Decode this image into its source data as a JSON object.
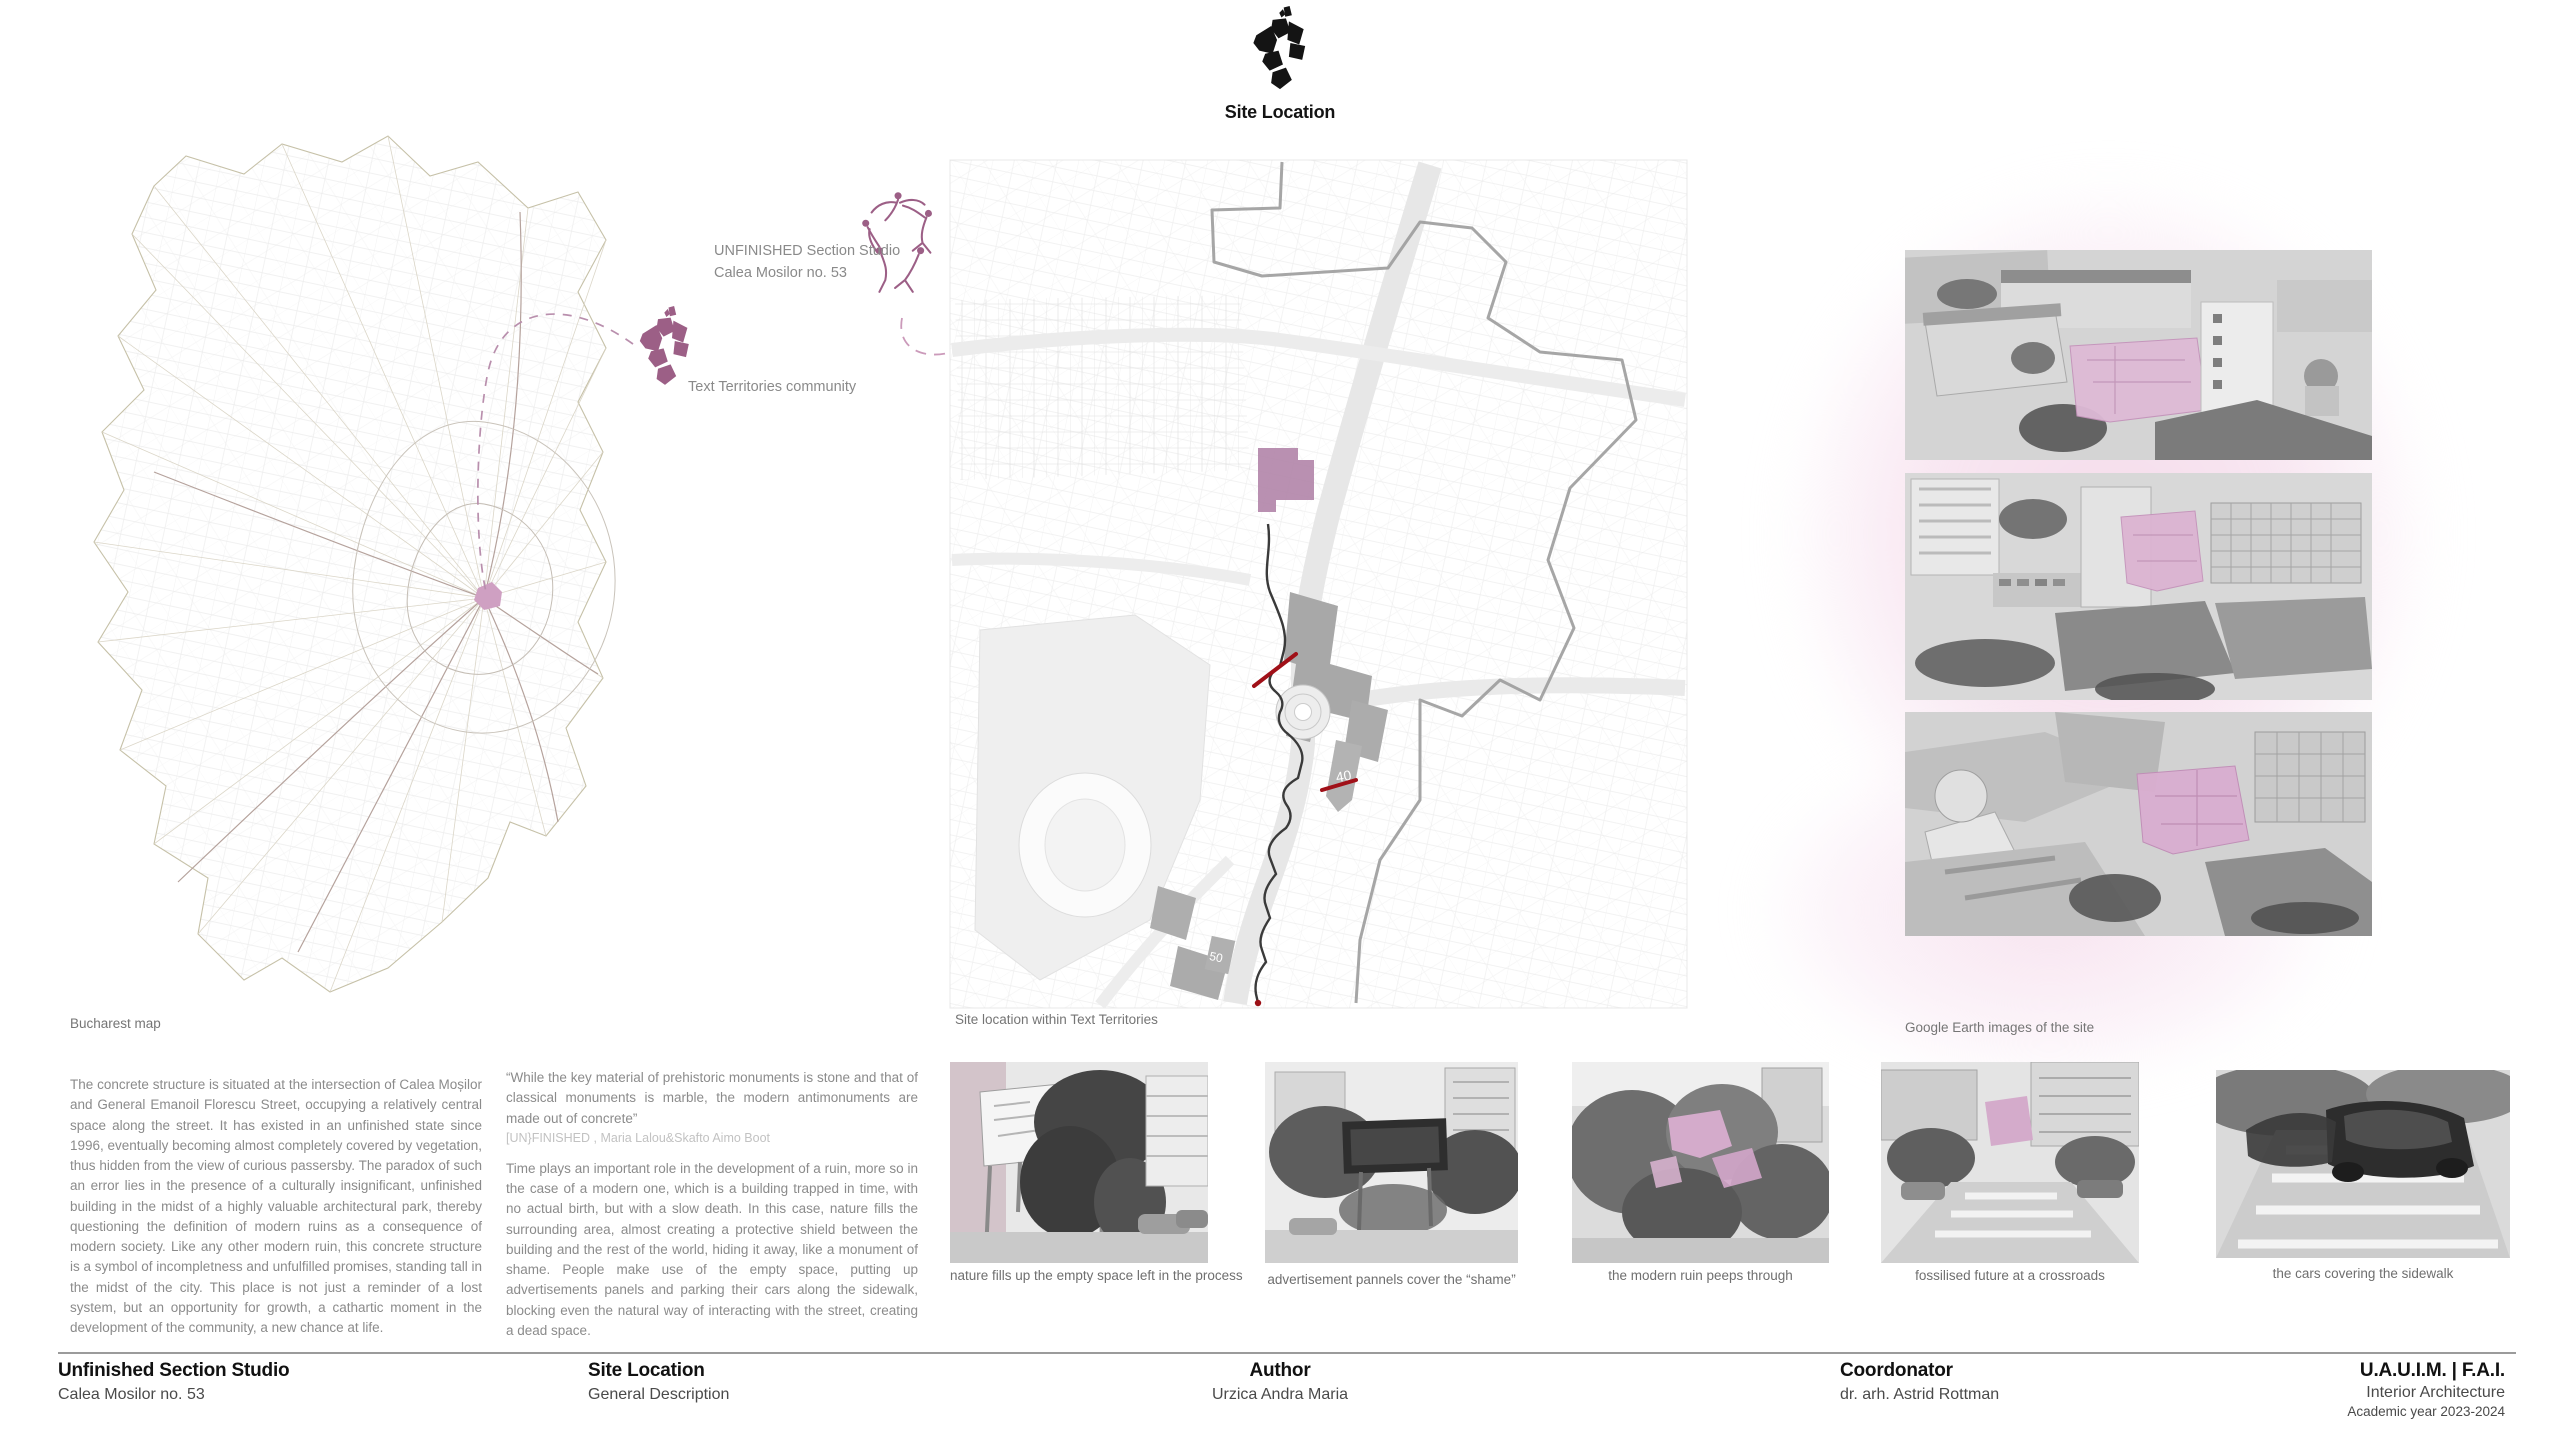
{
  "header": {
    "title": "Site Location",
    "logo_icon": "fragmented-city-plan-logo"
  },
  "annotations": {
    "studio_line1": "UNFINISHED Section Studio",
    "studio_line2": "Calea Mosilor no. 53",
    "community_label": "Text Territories community"
  },
  "captions": {
    "bucharest_map": "Bucharest map",
    "site_map": "Site location within Text Territories",
    "google_earth": "Google Earth images of the site"
  },
  "site_map": {
    "labels": [
      "40",
      "50"
    ]
  },
  "body": {
    "paragraph1": "The concrete structure is situated at the intersection of Calea Moșilor and General Emanoil Florescu Street, occupying a relatively central space along the street. It has existed in an unfinished state since 1996, eventually becoming almost completely covered by vegetation, thus hidden from the view of curious passersby. The paradox of such an error lies in the presence of a culturally insignificant, unfinished building in the midst of a highly valuable architectural park, thereby questioning the definition of modern ruins as a consequence of modern society. Like any other modern ruin, this concrete structure is a symbol of incompletness and unfulfilled promises, standing tall in the  midst of the city. This place is  not just a reminder of a lost system, but an opportunity for growth, a cathartic moment in the development of  the community, a new chance at life.",
    "quote": "“While the key material of prehistoric monuments is stone and that of classical monuments is marble, the modern antimonuments are made out of concrete”",
    "quote_attribution": "[UN}FINISHED , Maria Lalou&Skafto Aimo Boot",
    "paragraph2": "Time plays an important role in the development of a ruin, more so in the case of a modern one, which is a building trapped in time, with no actual birth, but with a slow death. In this case, nature fills the surrounding area, almost creating a protective shield between the building and the rest of the world, hiding it away, like a monument of shame. People make use of the empty space, putting up advertisements panels and parking their cars along the sidewalk, blocking even the natural way of interacting with the street, creating a dead space."
  },
  "photo_strip": [
    {
      "caption": "nature fills up the empty space left in the process"
    },
    {
      "caption": "advertisement pannels cover the “shame”"
    },
    {
      "caption": "the modern ruin peeps through"
    },
    {
      "caption": "fossilised future at a crossroads"
    },
    {
      "caption": "the cars covering the sidewalk"
    }
  ],
  "footer": {
    "columns": [
      {
        "title": "Unfinished Section Studio",
        "subtitle": "Calea Mosilor no. 53"
      },
      {
        "title": "Site Location",
        "subtitle": "General Description"
      },
      {
        "title": "Author",
        "subtitle": "Urzica Andra Maria"
      },
      {
        "title": "Coordonator",
        "subtitle": "dr. arh. Astrid Rottman"
      }
    ],
    "institution": {
      "line1": "U.A.U.I.M.  |  F.A.I.",
      "line2": "Interior Architecture",
      "line3": "Academic year 2023-2024"
    }
  },
  "colors": {
    "accent_purple": "#9c5f86",
    "site_highlight_pink": "#d9b0d0",
    "blob_pink": "#f7e2ee",
    "route_black": "#3a3a3a",
    "section_red": "#a01018",
    "map_line_gray": "#c9c9c9"
  }
}
